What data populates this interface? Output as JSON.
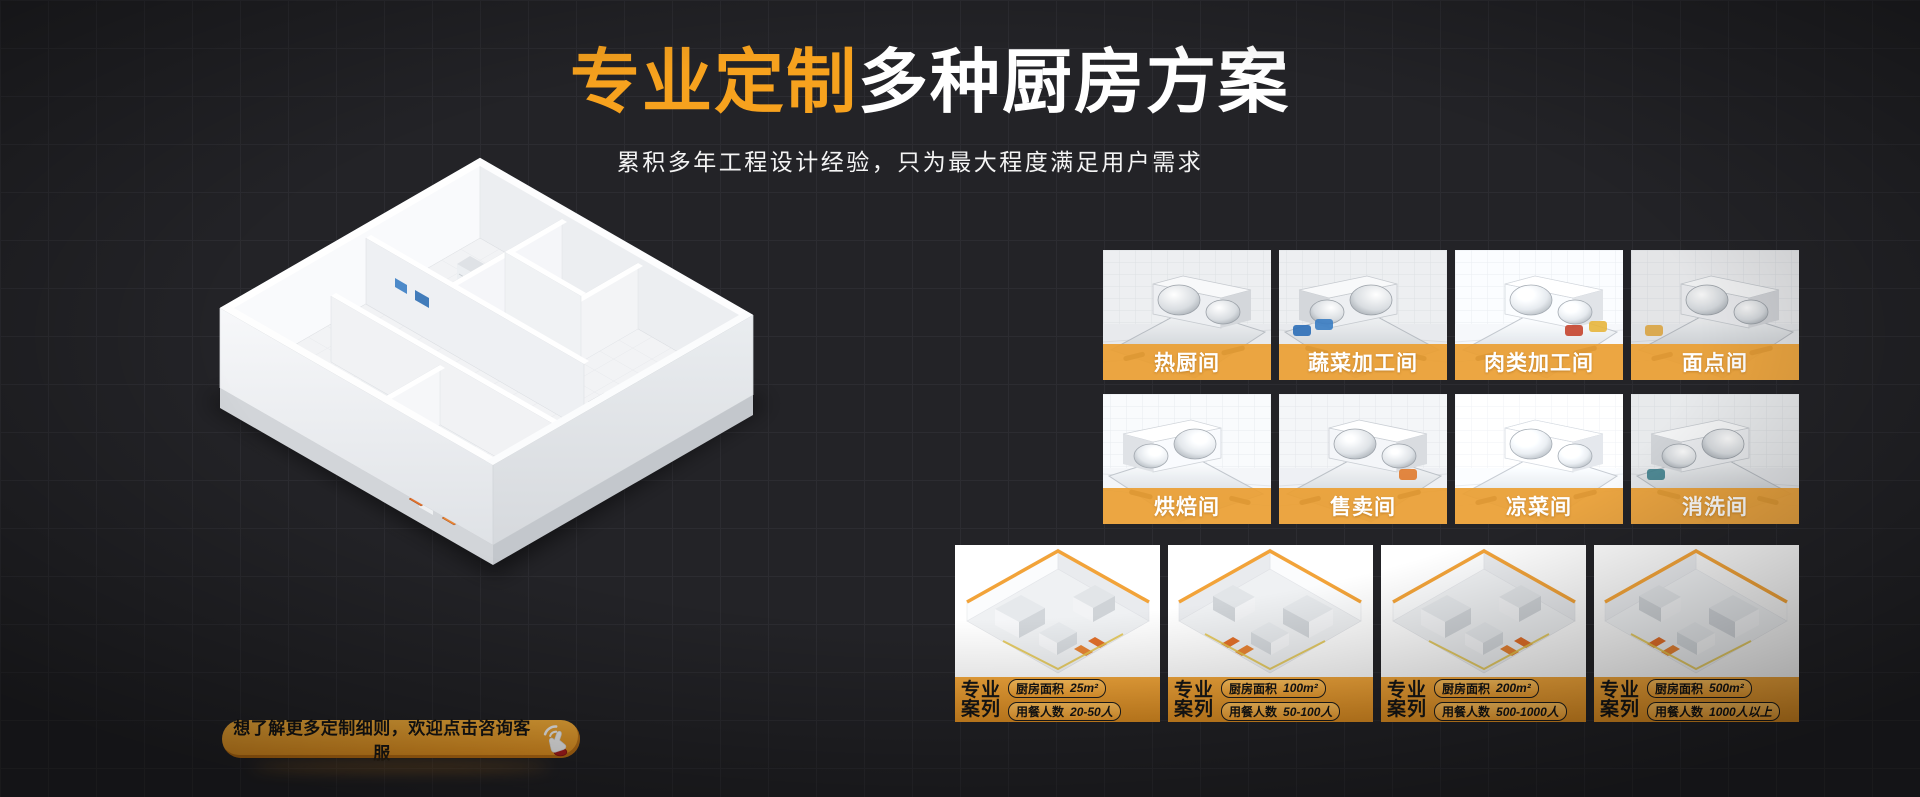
{
  "colors": {
    "background": "#232327",
    "accent_orange": "#F7A21E",
    "room_label_bar": "#EB9F34",
    "case_footer_start": "#F3A73B",
    "case_footer_end": "#DE8E22",
    "cta_fill": "#F2A42E",
    "title_rest_color": "#FFFFFF"
  },
  "header": {
    "title_highlight": "专业定制",
    "title_rest": "多种厨房方案",
    "subtitle": "累积多年工程设计经验，只为最大程度满足用户需求"
  },
  "rooms": [
    {
      "label": "热厨间"
    },
    {
      "label": "蔬菜加工间"
    },
    {
      "label": "肉类加工间"
    },
    {
      "label": "面点间"
    },
    {
      "label": "烘焙间"
    },
    {
      "label": "售卖间"
    },
    {
      "label": "凉菜间"
    },
    {
      "label": "消洗间"
    }
  ],
  "cases": [
    {
      "badge_top": "专业",
      "badge_bottom": "案列",
      "area_label": "厨房面积",
      "area_value": "25m²",
      "diners_label": "用餐人数",
      "diners_value": "20-50人"
    },
    {
      "badge_top": "专业",
      "badge_bottom": "案列",
      "area_label": "厨房面积",
      "area_value": "100m²",
      "diners_label": "用餐人数",
      "diners_value": "50-100人"
    },
    {
      "badge_top": "专业",
      "badge_bottom": "案列",
      "area_label": "厨房面积",
      "area_value": "200m²",
      "diners_label": "用餐人数",
      "diners_value": "500-1000人"
    },
    {
      "badge_top": "专业",
      "badge_bottom": "案列",
      "area_label": "厨房面积",
      "area_value": "500m²",
      "diners_label": "用餐人数",
      "diners_value": "1000人以上"
    }
  ],
  "cta": {
    "label": "想了解更多定制细则，欢迎点击咨询客服"
  }
}
